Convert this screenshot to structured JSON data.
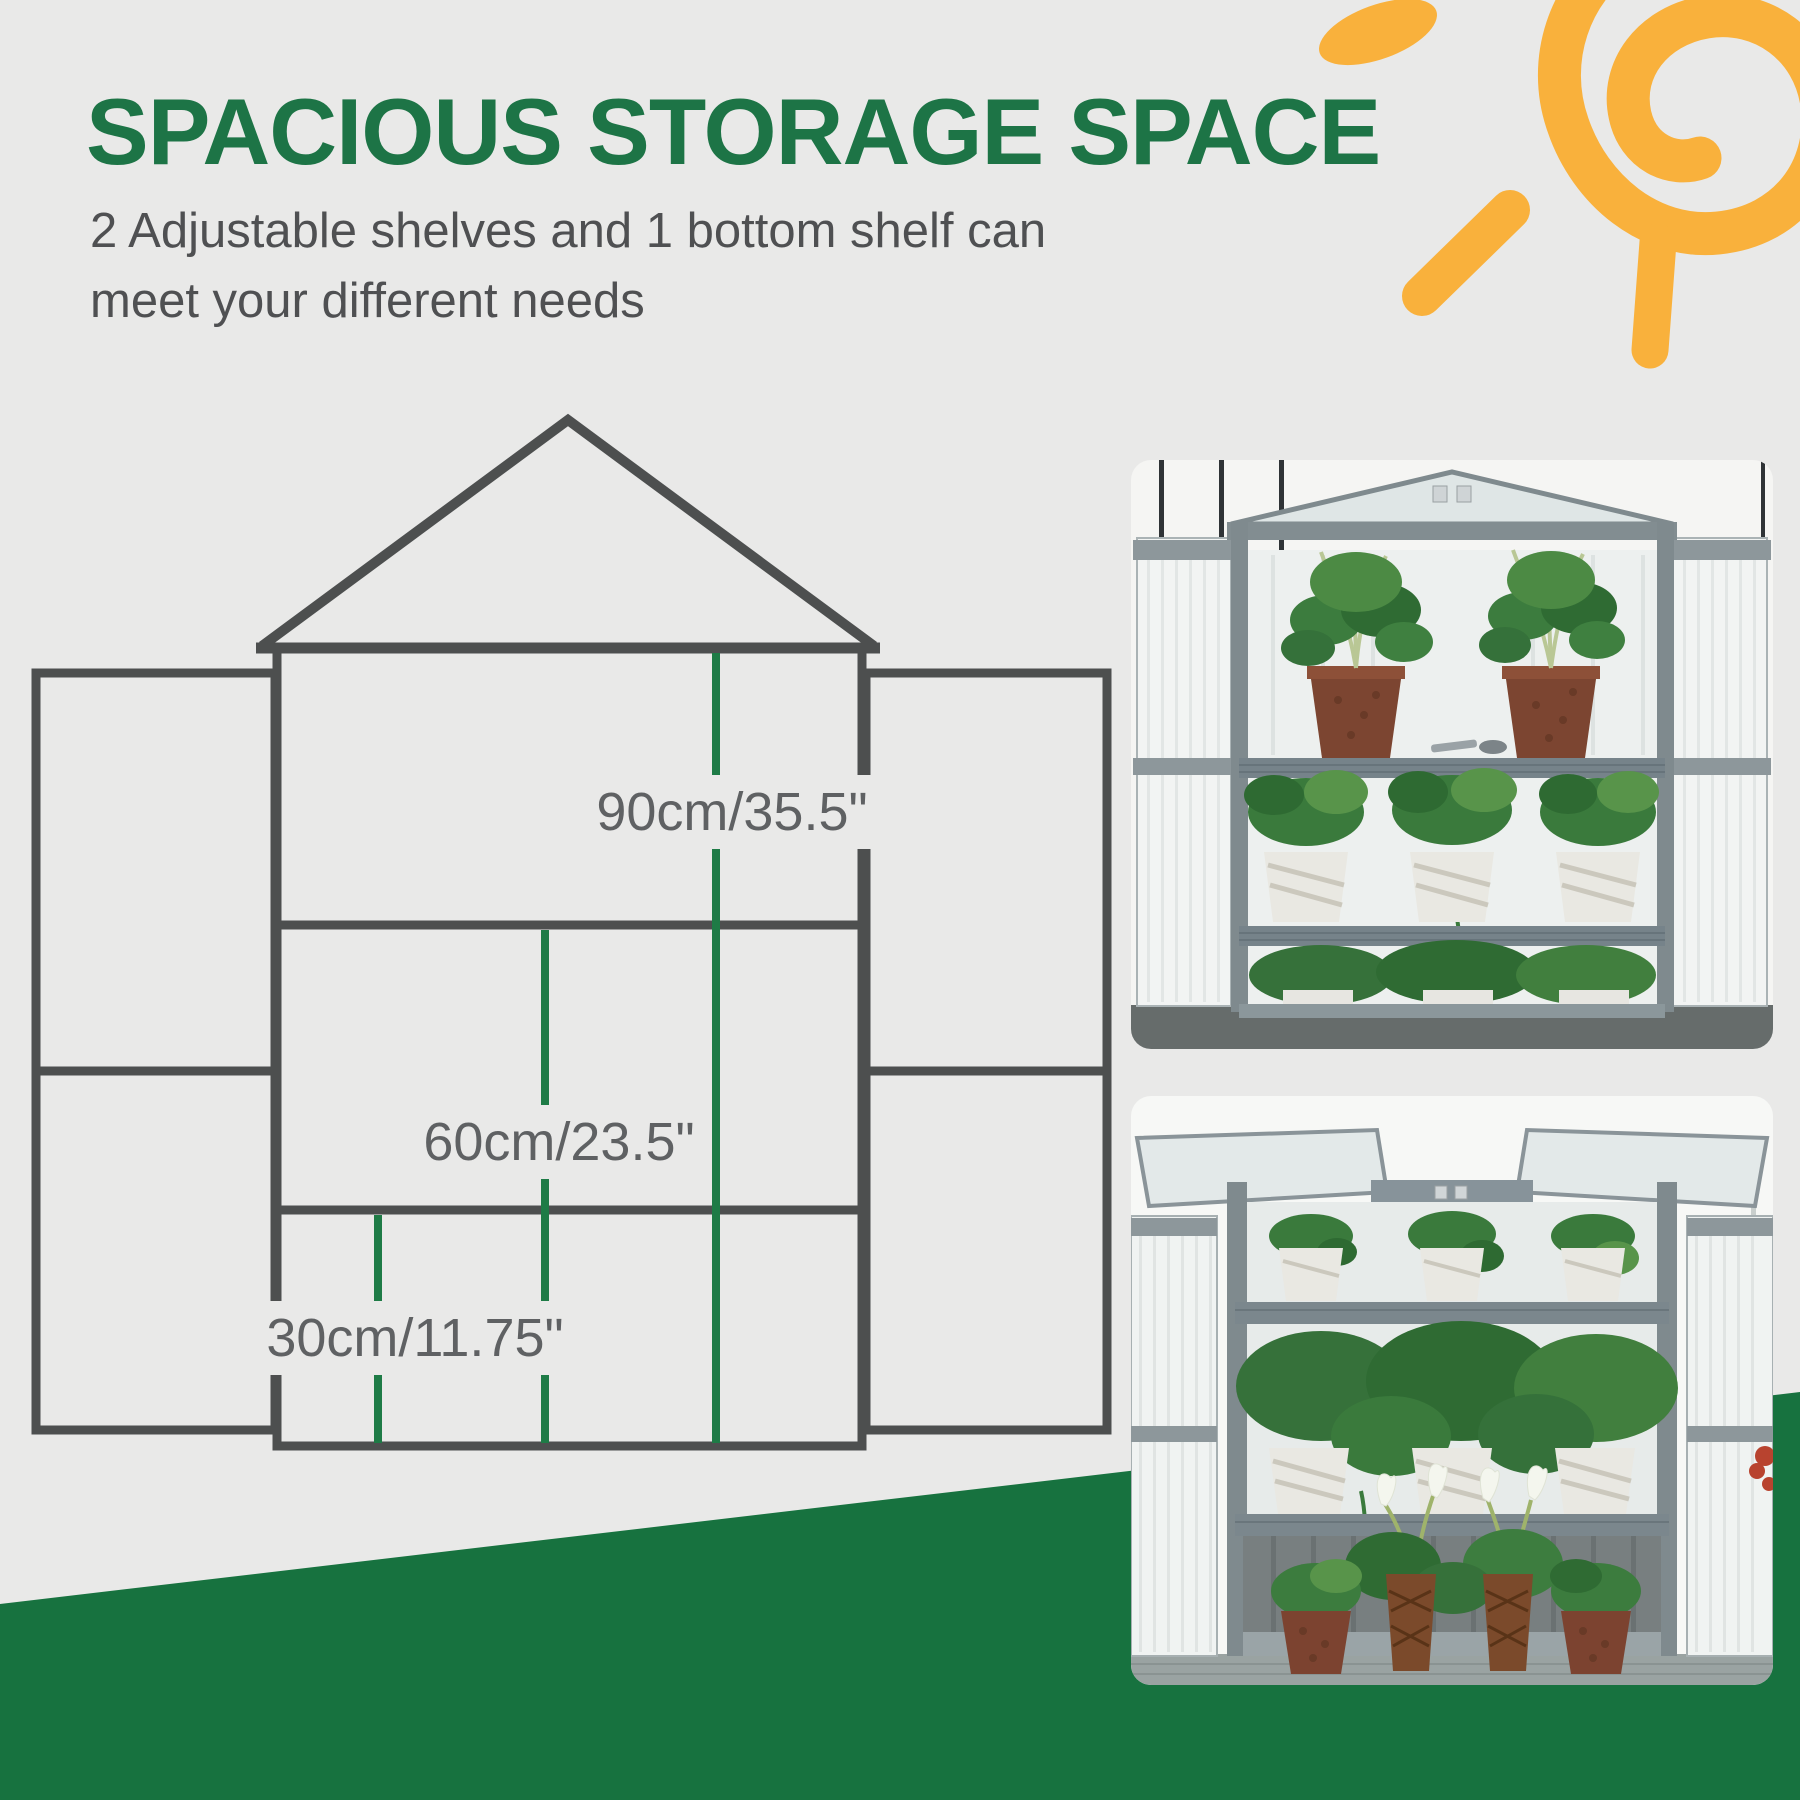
{
  "page": {
    "background_color": "#e9e9e8"
  },
  "header": {
    "title": "SPACIOUS STORAGE SPACE",
    "title_color": "#1d7446",
    "subtitle_line1": "2 Adjustable shelves and 1 bottom shelf can",
    "subtitle_line2": "meet your different needs"
  },
  "diagram": {
    "frame_color": "#4d4f4f",
    "dimension_line_color": "#1e7b46",
    "labels": {
      "height": "90cm/35.5\"",
      "middle_shelf": "60cm/23.5\"",
      "bottom_shelf": "30cm/11.75\""
    }
  },
  "photos": {
    "top": {
      "alt": "Grey wooden cold frame greenhouse with doors open, two adjustable shelves holding brown pots and white pots of green plants"
    },
    "bottom": {
      "alt": "Grey wooden cold frame greenhouse with roof lids open, shelf of potted plants and tall calla lily planters on the bottom shelf"
    }
  },
  "decor": {
    "sun_color": "#f9b13c",
    "banner_color": "#17723f"
  }
}
